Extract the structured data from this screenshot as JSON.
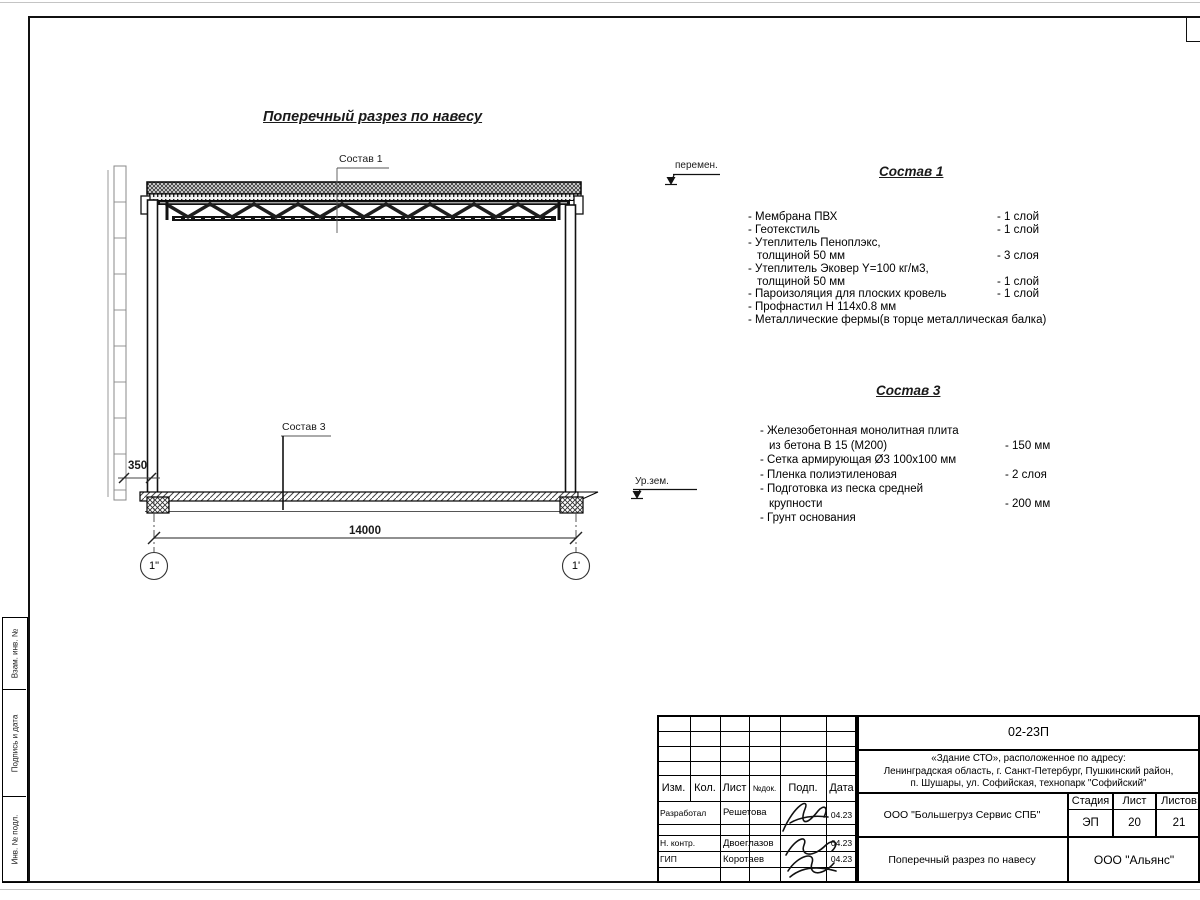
{
  "drawing": {
    "title": "Поперечный разрез по навесу",
    "callout1": "Состав 1",
    "callout3": "Состав 3",
    "dim_width": "14000",
    "dim_offset": "350",
    "axis_left": "1\"",
    "axis_right": "1'",
    "ground_level": "Ур.зем.",
    "variable": "перемен."
  },
  "sostav1": {
    "title": "Состав 1",
    "lines": [
      {
        "text": "- Мембрана ПВХ",
        "value": "- 1 слой"
      },
      {
        "text": "- Геотекстиль",
        "value": "- 1 слой"
      },
      {
        "text": "- Утеплитель Пеноплэкс,",
        "value": ""
      },
      {
        "text": "толщиной 50 мм",
        "value": "- 3 слоя"
      },
      {
        "text": "- Утеплитель Эковер Y=100 кг/м3,",
        "value": ""
      },
      {
        "text": "толщиной 50 мм",
        "value": "- 1 слой"
      },
      {
        "text": "- Пароизоляция для плоских кровель",
        "value": "- 1 слой"
      },
      {
        "text": "- Профнастил Н 114х0.8 мм",
        "value": ""
      },
      {
        "text": "- Металлические фермы(в торце металлическая балка)",
        "value": ""
      }
    ]
  },
  "sostav3": {
    "title": "Состав 3",
    "lines": [
      {
        "text": "- Железобетонная  монолитная плита",
        "value": ""
      },
      {
        "text": "из бетона В 15 (М200)",
        "value": "- 150 мм"
      },
      {
        "text": "- Сетка армирующая Ø3 100х100 мм",
        "value": ""
      },
      {
        "text": "- Пленка полиэтиленовая",
        "value": "-  2 слоя"
      },
      {
        "text": "- Подготовка из песка средней",
        "value": ""
      },
      {
        "text": "крупности",
        "value": "- 200 мм"
      },
      {
        "text": "- Грунт основания",
        "value": ""
      }
    ]
  },
  "titleblock": {
    "doc_code": "02-23П",
    "address": [
      "«Здание СТО», расположенное по адресу:",
      "Ленинградская область, г. Санкт-Петербург, Пушкинский район,",
      "п. Шушары, ул. Софийская, технопарк \"Софийский\""
    ],
    "columns": [
      "Изм.",
      "Кол.",
      "Лист",
      "№док.",
      "Подп.",
      "Дата"
    ],
    "rows": [
      {
        "role": "Разработал",
        "name": "Решетова",
        "date": "04.23"
      },
      {
        "role": "Н. контр.",
        "name": "Двоеглазов",
        "date": "04.23"
      },
      {
        "role": "ГИП",
        "name": "Коротаев",
        "date": "04.23"
      }
    ],
    "company": "ООО \"Большегруз Сервис СПБ\"",
    "sheet_title": "Поперечный разрез по навесу",
    "org": "ООО \"Альянс\"",
    "stage_label": "Стадия",
    "sheet_label": "Лист",
    "sheets_label": "Листов",
    "stage": "ЭП",
    "sheet": "20",
    "sheets": "21"
  },
  "side_strip": {
    "labels": [
      "Взам. инв. №",
      "Подпись и дата",
      "Инв. № подл."
    ]
  }
}
